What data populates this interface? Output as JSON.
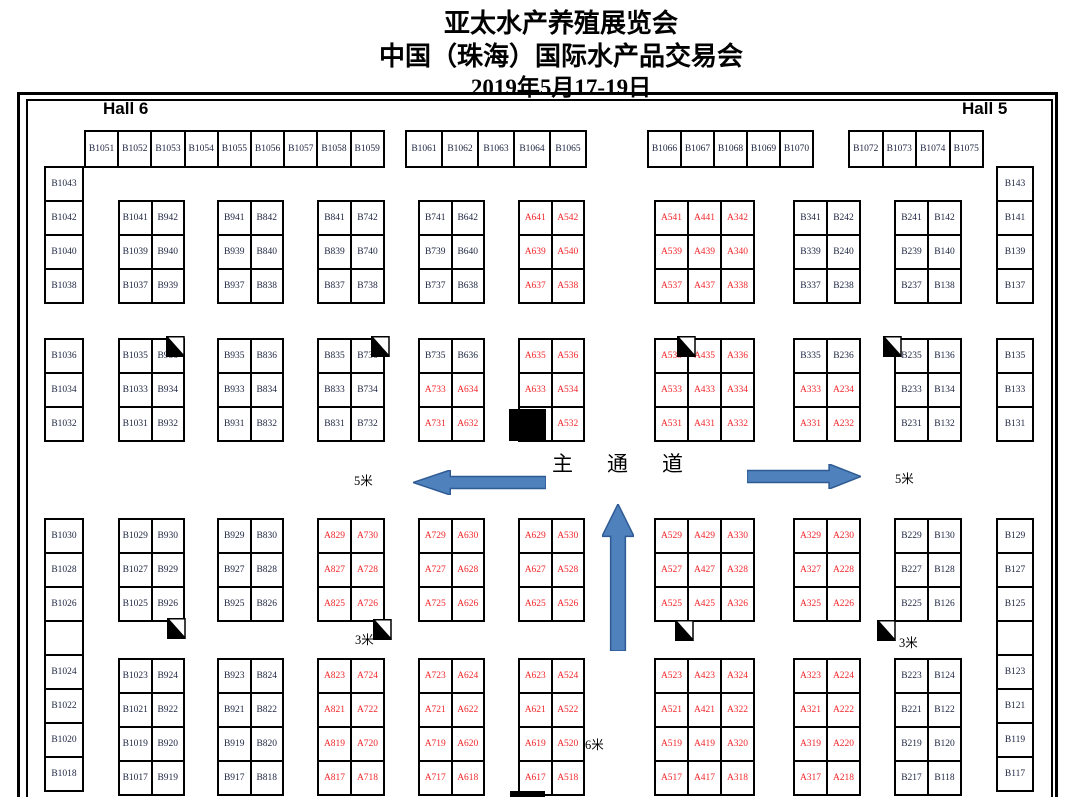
{
  "title": {
    "line1": "亚太水产养殖展览会",
    "line2": "中国（珠海）国际水产品交易会",
    "line3": "2019年5月17-19日"
  },
  "halls": {
    "left": "Hall 6",
    "right": "Hall 5"
  },
  "aisle": {
    "text": "主通道"
  },
  "colors": {
    "booth_a_text": "#f2262a",
    "booth_b_text": "#1c2440",
    "arrow_fill": "#4f81bd",
    "arrow_stroke": "#2e5b94",
    "line": "#000000"
  },
  "top_row_groups": [
    {
      "x": 84,
      "y": 130,
      "cell_w": 33.2,
      "cell_h": 36,
      "cells": [
        "B1051",
        "B1052",
        "B1053",
        "B1054",
        "B1055",
        "B1056",
        "B1057",
        "B1058",
        "B1059"
      ]
    },
    {
      "x": 405,
      "y": 130,
      "cell_w": 36,
      "cell_h": 36,
      "cells": [
        "B1061",
        "B1062",
        "B1063",
        "B1064",
        "B1065"
      ]
    },
    {
      "x": 647,
      "y": 130,
      "cell_w": 33,
      "cell_h": 36,
      "cells": [
        "B1066",
        "B1067",
        "B1068",
        "B1069",
        "B1070"
      ]
    },
    {
      "x": 848,
      "y": 130,
      "cell_w": 33.5,
      "cell_h": 36,
      "cells": [
        "B1072",
        "B1073",
        "B1074",
        "B1075"
      ]
    }
  ],
  "side_columns": [
    {
      "name": "left-column",
      "x": 44,
      "w": 38,
      "cell_h": 34,
      "segments": [
        {
          "y": 166,
          "cells": [
            "B1043",
            "B1042",
            "B1040",
            "B1038"
          ]
        },
        {
          "y": 338,
          "cells": [
            "B1036",
            "B1034",
            "B1032"
          ]
        },
        {
          "y": 518,
          "cells": [
            "B1030",
            "B1028",
            "B1026",
            "",
            "B1024",
            "B1022",
            "B1020",
            "B1018"
          ]
        }
      ]
    },
    {
      "name": "right-column",
      "x": 996,
      "w": 36,
      "cell_h": 34,
      "segments": [
        {
          "y": 166,
          "cells": [
            "B143",
            "B141",
            "B139",
            "B137"
          ]
        },
        {
          "y": 338,
          "cells": [
            "B135",
            "B133",
            "B131"
          ]
        },
        {
          "y": 518,
          "cells": [
            "B129",
            "B127",
            "B125",
            "",
            "B123",
            "B121",
            "B119",
            "B117"
          ]
        }
      ]
    }
  ],
  "blocks": [
    {
      "x": 118,
      "y": 200,
      "cell_w": 32.5,
      "cell_h": 34,
      "rows": [
        [
          "B1041",
          "B942"
        ],
        [
          "B1039",
          "B940"
        ],
        [
          "B1037",
          "B939"
        ]
      ]
    },
    {
      "x": 217,
      "y": 200,
      "cell_w": 32.5,
      "cell_h": 34,
      "rows": [
        [
          "B941",
          "B842"
        ],
        [
          "B939",
          "B840"
        ],
        [
          "B937",
          "B838"
        ]
      ]
    },
    {
      "x": 317,
      "y": 200,
      "cell_w": 33,
      "cell_h": 34,
      "rows": [
        [
          "B841",
          "B742"
        ],
        [
          "B839",
          "B740"
        ],
        [
          "B837",
          "B738"
        ]
      ]
    },
    {
      "x": 418,
      "y": 200,
      "cell_w": 32.5,
      "cell_h": 34,
      "rows": [
        [
          "B741",
          "B642"
        ],
        [
          "B739",
          "B640"
        ],
        [
          "B737",
          "B638"
        ]
      ]
    },
    {
      "x": 518,
      "y": 200,
      "cell_w": 32.5,
      "cell_h": 34,
      "rows": [
        [
          "A641",
          "A542"
        ],
        [
          "A639",
          "A540"
        ],
        [
          "A637",
          "A538"
        ]
      ]
    },
    {
      "x": 654,
      "y": 200,
      "cell_w": 33,
      "cell_h": 34,
      "rows": [
        [
          "A541",
          "A441",
          "A342"
        ],
        [
          "A539",
          "A439",
          "A340"
        ],
        [
          "A537",
          "A437",
          "A338"
        ]
      ]
    },
    {
      "x": 793,
      "y": 200,
      "cell_w": 33,
      "cell_h": 34,
      "rows": [
        [
          "B341",
          "B242"
        ],
        [
          "B339",
          "B240"
        ],
        [
          "B337",
          "B238"
        ]
      ]
    },
    {
      "x": 894,
      "y": 200,
      "cell_w": 33,
      "cell_h": 34,
      "rows": [
        [
          "B241",
          "B142"
        ],
        [
          "B239",
          "B140"
        ],
        [
          "B237",
          "B138"
        ]
      ]
    },
    {
      "x": 118,
      "y": 338,
      "cell_w": 32.5,
      "cell_h": 34,
      "rows": [
        [
          "B1035",
          "B936"
        ],
        [
          "B1033",
          "B934"
        ],
        [
          "B1031",
          "B932"
        ]
      ]
    },
    {
      "x": 217,
      "y": 338,
      "cell_w": 32.5,
      "cell_h": 34,
      "rows": [
        [
          "B935",
          "B836"
        ],
        [
          "B933",
          "B834"
        ],
        [
          "B931",
          "B832"
        ]
      ]
    },
    {
      "x": 317,
      "y": 338,
      "cell_w": 33,
      "cell_h": 34,
      "rows": [
        [
          "B835",
          "B736"
        ],
        [
          "B833",
          "B734"
        ],
        [
          "B831",
          "B732"
        ]
      ]
    },
    {
      "x": 418,
      "y": 338,
      "cell_w": 32.5,
      "cell_h": 34,
      "rows": [
        [
          "B735",
          "B636"
        ],
        [
          "A733",
          "A634"
        ],
        [
          "A731",
          "A632"
        ]
      ]
    },
    {
      "x": 518,
      "y": 338,
      "cell_w": 32.5,
      "cell_h": 34,
      "rows": [
        [
          "A635",
          "A536"
        ],
        [
          "A633",
          "A534"
        ],
        [
          "",
          "A532"
        ]
      ]
    },
    {
      "x": 654,
      "y": 338,
      "cell_w": 33,
      "cell_h": 34,
      "rows": [
        [
          "A535",
          "A435",
          "A336"
        ],
        [
          "A533",
          "A433",
          "A334"
        ],
        [
          "A531",
          "A431",
          "A332"
        ]
      ]
    },
    {
      "x": 793,
      "y": 338,
      "cell_w": 33,
      "cell_h": 34,
      "rows": [
        [
          "B335",
          "B236"
        ],
        [
          "A333",
          "A234"
        ],
        [
          "A331",
          "A232"
        ]
      ]
    },
    {
      "x": 894,
      "y": 338,
      "cell_w": 33,
      "cell_h": 34,
      "rows": [
        [
          "B235",
          "B136"
        ],
        [
          "B233",
          "B134"
        ],
        [
          "B231",
          "B132"
        ]
      ]
    },
    {
      "x": 118,
      "y": 518,
      "cell_w": 32.5,
      "cell_h": 34,
      "rows": [
        [
          "B1029",
          "B930"
        ],
        [
          "B1027",
          "B929"
        ],
        [
          "B1025",
          "B926"
        ]
      ]
    },
    {
      "x": 217,
      "y": 518,
      "cell_w": 32.5,
      "cell_h": 34,
      "rows": [
        [
          "B929",
          "B830"
        ],
        [
          "B927",
          "B828"
        ],
        [
          "B925",
          "B826"
        ]
      ]
    },
    {
      "x": 317,
      "y": 518,
      "cell_w": 33,
      "cell_h": 34,
      "rows": [
        [
          "A829",
          "A730"
        ],
        [
          "A827",
          "A728"
        ],
        [
          "A825",
          "A726"
        ]
      ]
    },
    {
      "x": 418,
      "y": 518,
      "cell_w": 32.5,
      "cell_h": 34,
      "rows": [
        [
          "A729",
          "A630"
        ],
        [
          "A727",
          "A628"
        ],
        [
          "A725",
          "A626"
        ]
      ]
    },
    {
      "x": 518,
      "y": 518,
      "cell_w": 32.5,
      "cell_h": 34,
      "rows": [
        [
          "A629",
          "A530"
        ],
        [
          "A627",
          "A528"
        ],
        [
          "A625",
          "A526"
        ]
      ]
    },
    {
      "x": 654,
      "y": 518,
      "cell_w": 33,
      "cell_h": 34,
      "rows": [
        [
          "A529",
          "A429",
          "A330"
        ],
        [
          "A527",
          "A427",
          "A328"
        ],
        [
          "A525",
          "A425",
          "A326"
        ]
      ]
    },
    {
      "x": 793,
      "y": 518,
      "cell_w": 33,
      "cell_h": 34,
      "rows": [
        [
          "A329",
          "A230"
        ],
        [
          "A327",
          "A228"
        ],
        [
          "A325",
          "A226"
        ]
      ]
    },
    {
      "x": 894,
      "y": 518,
      "cell_w": 33,
      "cell_h": 34,
      "rows": [
        [
          "B229",
          "B130"
        ],
        [
          "B227",
          "B128"
        ],
        [
          "B225",
          "B126"
        ]
      ]
    },
    {
      "x": 118,
      "y": 658,
      "cell_w": 32.5,
      "cell_h": 34,
      "rows": [
        [
          "B1023",
          "B924"
        ],
        [
          "B1021",
          "B922"
        ],
        [
          "B1019",
          "B920"
        ],
        [
          "B1017",
          "B919"
        ]
      ]
    },
    {
      "x": 217,
      "y": 658,
      "cell_w": 32.5,
      "cell_h": 34,
      "rows": [
        [
          "B923",
          "B824"
        ],
        [
          "B921",
          "B822"
        ],
        [
          "B919",
          "B820"
        ],
        [
          "B917",
          "B818"
        ]
      ]
    },
    {
      "x": 317,
      "y": 658,
      "cell_w": 33,
      "cell_h": 34,
      "rows": [
        [
          "A823",
          "A724"
        ],
        [
          "A821",
          "A722"
        ],
        [
          "A819",
          "A720"
        ],
        [
          "A817",
          "A718"
        ]
      ]
    },
    {
      "x": 418,
      "y": 658,
      "cell_w": 32.5,
      "cell_h": 34,
      "rows": [
        [
          "A723",
          "A624"
        ],
        [
          "A721",
          "A622"
        ],
        [
          "A719",
          "A620"
        ],
        [
          "A717",
          "A618"
        ]
      ]
    },
    {
      "x": 518,
      "y": 658,
      "cell_w": 32.5,
      "cell_h": 34,
      "rows": [
        [
          "A623",
          "A524"
        ],
        [
          "A621",
          "A522"
        ],
        [
          "A619",
          "A520"
        ],
        [
          "A617",
          "A518"
        ]
      ]
    },
    {
      "x": 654,
      "y": 658,
      "cell_w": 33,
      "cell_h": 34,
      "rows": [
        [
          "A523",
          "A423",
          "A324"
        ],
        [
          "A521",
          "A421",
          "A322"
        ],
        [
          "A519",
          "A419",
          "A320"
        ],
        [
          "A517",
          "A417",
          "A318"
        ]
      ]
    },
    {
      "x": 793,
      "y": 658,
      "cell_w": 33,
      "cell_h": 34,
      "rows": [
        [
          "A323",
          "A224"
        ],
        [
          "A321",
          "A222"
        ],
        [
          "A319",
          "A220"
        ],
        [
          "A317",
          "A218"
        ]
      ]
    },
    {
      "x": 894,
      "y": 658,
      "cell_w": 33,
      "cell_h": 34,
      "rows": [
        [
          "B223",
          "B124"
        ],
        [
          "B221",
          "B122"
        ],
        [
          "B219",
          "B120"
        ],
        [
          "B217",
          "B118"
        ]
      ]
    }
  ],
  "arrows": [
    {
      "dir": "left",
      "x": 413,
      "y": 470,
      "w": 133,
      "h": 25
    },
    {
      "dir": "right",
      "x": 747,
      "y": 464,
      "w": 114,
      "h": 25
    },
    {
      "dir": "up",
      "x": 602,
      "y": 504,
      "w": 32,
      "h": 147
    }
  ],
  "size_labels": [
    {
      "text": "5米",
      "x": 354,
      "y": 470
    },
    {
      "text": "5米",
      "x": 895,
      "y": 468
    },
    {
      "text": "3米",
      "x": 355,
      "y": 629
    },
    {
      "text": "3米",
      "x": 899,
      "y": 632
    },
    {
      "text": "6米",
      "x": 585,
      "y": 734
    }
  ],
  "corner_markers": [
    {
      "x": 166,
      "y": 336
    },
    {
      "x": 371,
      "y": 336
    },
    {
      "x": 677,
      "y": 336
    },
    {
      "x": 883,
      "y": 336
    },
    {
      "x": 167,
      "y": 618
    },
    {
      "x": 373,
      "y": 619
    },
    {
      "x": 675,
      "y": 620
    },
    {
      "x": 877,
      "y": 620
    }
  ],
  "pillars": [
    {
      "x": 509,
      "y": 409,
      "w": 37,
      "h": 32
    },
    {
      "x": 510,
      "y": 791,
      "w": 35,
      "h": 6
    }
  ]
}
